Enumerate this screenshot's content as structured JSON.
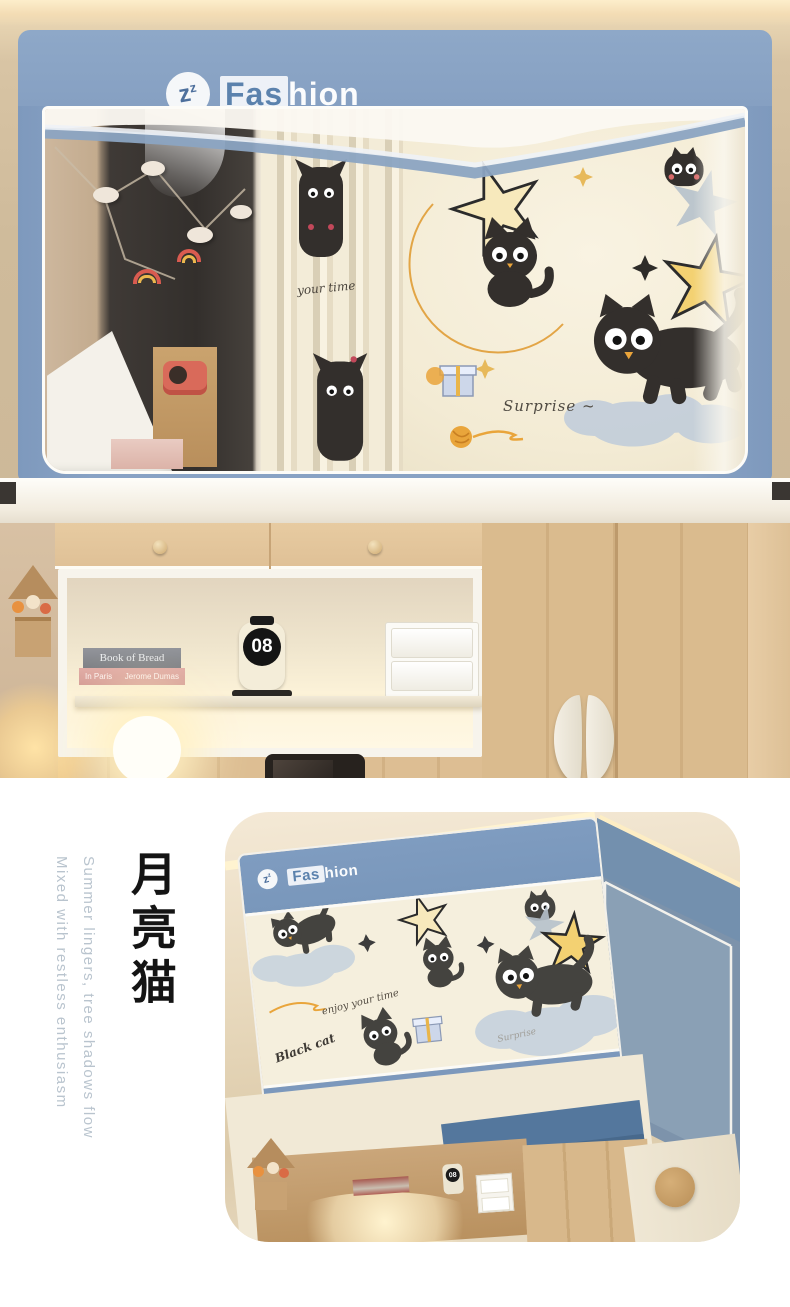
{
  "brand": {
    "logo_z_big": "z",
    "logo_z_small": "z",
    "name_boxed": "Fas",
    "name_rest": "hion"
  },
  "top_photo": {
    "curtain_script": "your time",
    "surprise_text": "Surprise ~",
    "shelf": {
      "book_top_title": "Book of Bread",
      "book_bottom_title": "In Paris",
      "book_bottom_author": "Jerome Dumas",
      "clock_value": "08"
    }
  },
  "bottom_photo": {
    "script_text": "enjoy your time",
    "black_cat_text": "Black cat",
    "surprise_text": "Surprise",
    "badge_line1": "Happy",
    "badge_line2": "Life",
    "clock_value": "08"
  },
  "caption": {
    "title": "月亮猫",
    "line1": "Summer lingers, tree shadows flow",
    "line2": "Mixed with restless enthusiasm"
  },
  "colors": {
    "canopy_blue": "#88a2c4",
    "canopy_blue_deep": "#6f8cab",
    "panel_cream": "#f5eedb",
    "badge_orange": "#d4622f",
    "wood": "#dcbd92",
    "caption_gray": "#b9c4ce"
  }
}
